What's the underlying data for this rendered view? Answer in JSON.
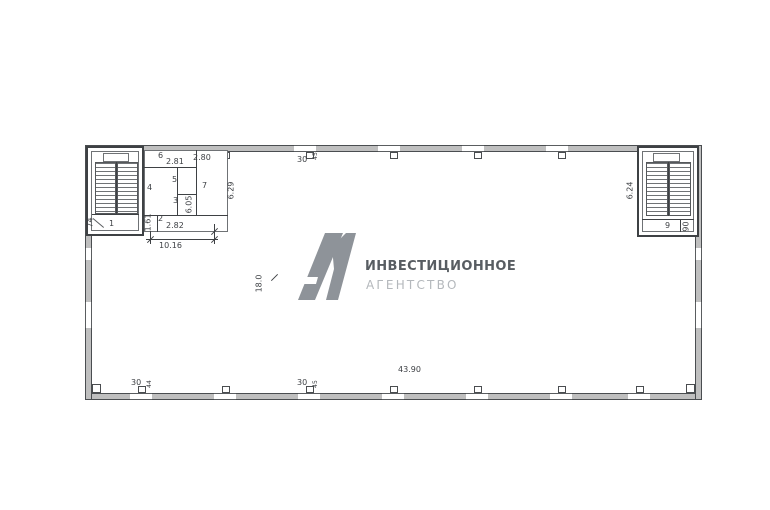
{
  "logo": {
    "mark": "A1",
    "title": "ИНВЕСТИЦИОННОЕ",
    "subtitle": "АГЕНТСТВО"
  },
  "labels": {
    "room1": "1",
    "room2": "2",
    "room3": "3",
    "room4": "4",
    "room5": "5",
    "room6": "6",
    "room7": "7",
    "room9": "9",
    "dim_2_81": "2.81",
    "dim_2_80": "2.80",
    "dim_6_29": "6.29",
    "dim_6_05": "6.05",
    "dim_1_61": "1.61",
    "dim_2_82": "2.82",
    "dim_10_16": "10.16",
    "dim_74": "74",
    "dim_30_top": "30",
    "dim_45_top": "45",
    "dim_30_bottom_left": "30",
    "dim_44_bottom_left": "44",
    "dim_30_bottom_mid": "30",
    "dim_45_bottom_mid": "45",
    "dim_18_0": "18.0",
    "dim_43_90": "43.90",
    "dim_6_24": "6.24",
    "dim_90": "90"
  },
  "colors": {
    "line": "#3e4144",
    "wall_fill": "#bfbfbf",
    "logo_mark": "#8e9399",
    "logo_title": "#585d62",
    "logo_subtitle": "#b4b8bc"
  }
}
